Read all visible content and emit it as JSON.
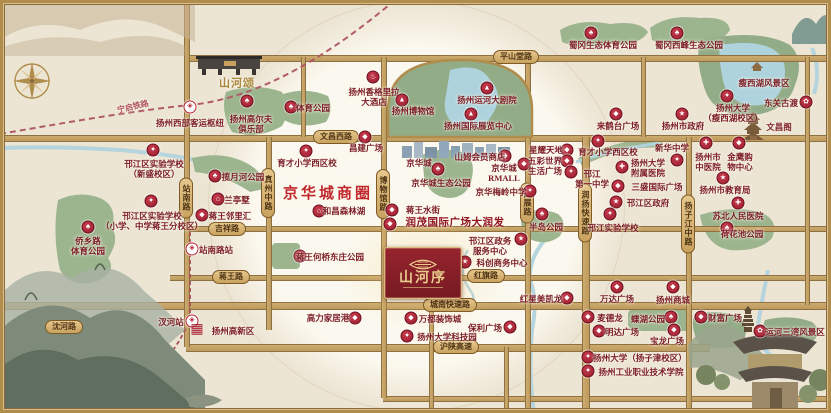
{
  "map": {
    "business_circle": "京华城商圈",
    "project": {
      "name": "山河序",
      "sister": "山河颂"
    },
    "colors": {
      "accent_red": "#a81f30",
      "road_gold": "#c3a267",
      "park_green": "#9db58f",
      "water_blue": "#aed3dd",
      "label_maroon": "#7b1c26"
    },
    "icon_glyphs": {
      "park": "♣",
      "school": "✦",
      "hospital": "✚",
      "gov": "★",
      "mall": "◆",
      "culture": "▲",
      "hotel": "♨",
      "scenic": "✿",
      "residence": "⌂",
      "metro": "◈",
      "hq": "▦"
    },
    "rail_labels": [
      {
        "label": "宁启铁路"
      },
      {
        "label": "宁扬城际（规划中）"
      }
    ],
    "roads": {
      "h": [
        {
          "y": 57,
          "x1": 186,
          "x2": 831,
          "w": 5
        },
        {
          "y": 137,
          "x1": 0,
          "x2": 831,
          "w": 5
        },
        {
          "y": 228,
          "x1": 186,
          "x2": 831,
          "w": 4
        },
        {
          "y": 277,
          "x1": 170,
          "x2": 831,
          "w": 4
        },
        {
          "y": 305,
          "x1": 0,
          "x2": 831,
          "w": 6
        },
        {
          "y": 347,
          "x1": 186,
          "x2": 710,
          "w": 6
        },
        {
          "y": 398,
          "x1": 383,
          "x2": 831,
          "w": 4
        }
      ],
      "v": [
        {
          "x": 186,
          "y1": 0,
          "y2": 347,
          "w": 4
        },
        {
          "x": 268,
          "y1": 137,
          "y2": 330,
          "w": 4
        },
        {
          "x": 302,
          "y1": 57,
          "y2": 137,
          "w": 3
        },
        {
          "x": 383,
          "y1": 57,
          "y2": 398,
          "w": 4
        },
        {
          "x": 527,
          "y1": 57,
          "y2": 413,
          "w": 4
        },
        {
          "x": 585,
          "y1": 137,
          "y2": 413,
          "w": 6
        },
        {
          "x": 642,
          "y1": 57,
          "y2": 137,
          "w": 3
        },
        {
          "x": 688,
          "y1": 137,
          "y2": 413,
          "w": 4
        },
        {
          "x": 806,
          "y1": 57,
          "y2": 305,
          "w": 3
        },
        {
          "x": 430,
          "y1": 277,
          "y2": 413,
          "w": 3
        },
        {
          "x": 505,
          "y1": 347,
          "y2": 413,
          "w": 3
        }
      ]
    },
    "road_labels": [
      {
        "label": "平山堂路",
        "x": 516,
        "y": 57
      },
      {
        "label": "文昌西路",
        "x": 336,
        "y": 137
      },
      {
        "label": "吉祥路",
        "x": 227,
        "y": 229
      },
      {
        "label": "蒋王路",
        "x": 231,
        "y": 277
      },
      {
        "label": "红旗路",
        "x": 486,
        "y": 276
      },
      {
        "label": "城南快速路",
        "x": 450,
        "y": 305
      },
      {
        "label": "沪陕高速",
        "x": 456,
        "y": 347
      },
      {
        "label": "沈河路",
        "x": 64,
        "y": 327
      },
      {
        "label": "站南路",
        "x": 186,
        "y": 198,
        "v": true
      },
      {
        "label": "真州中路",
        "x": 268,
        "y": 193,
        "v": true
      },
      {
        "label": "博物馆路",
        "x": 383,
        "y": 194,
        "v": true
      },
      {
        "label": "国展路",
        "x": 527,
        "y": 203,
        "v": true
      },
      {
        "label": "润扬快速路",
        "x": 585,
        "y": 213,
        "v": true
      },
      {
        "label": "扬子江中路",
        "x": 688,
        "y": 224,
        "v": true
      }
    ],
    "landmarks": [
      {
        "label": "扬州西部客运枢纽",
        "t": [
          190,
          123
        ],
        "i": [
          190,
          107
        ],
        "g": "metro"
      },
      {
        "label": "扬州高尔夫\n俱乐部",
        "t": [
          251,
          124
        ],
        "i": [
          247,
          101
        ],
        "g": "park"
      },
      {
        "label": "体育公园",
        "t": [
          313,
          108
        ],
        "i": [
          291,
          107
        ],
        "g": "park"
      },
      {
        "label": "扬州香格里拉\n大酒店",
        "t": [
          374,
          97
        ],
        "i": [
          373,
          77
        ],
        "g": "hotel"
      },
      {
        "label": "扬州博物馆",
        "t": [
          413,
          111
        ],
        "i": [
          402,
          100
        ],
        "g": "culture"
      },
      {
        "label": "扬州运河大剧院",
        "t": [
          487,
          100
        ],
        "i": [
          487,
          88
        ],
        "g": "culture"
      },
      {
        "label": "扬州国际展览中心",
        "t": [
          478,
          126
        ],
        "i": [
          471,
          114
        ],
        "g": "culture"
      },
      {
        "label": "蜀冈生态体育公园",
        "t": [
          603,
          45
        ],
        "i": [
          591,
          33
        ],
        "g": "park"
      },
      {
        "label": "蜀冈西峰生态公园",
        "t": [
          689,
          45
        ],
        "i": [
          677,
          33
        ],
        "g": "park"
      },
      {
        "label": "瘦西湖风景区",
        "t": [
          764,
          83
        ]
      },
      {
        "label": "扬州大学\n（瘦西湖校区）",
        "t": [
          733,
          113
        ],
        "i": [
          727,
          96
        ],
        "g": "school"
      },
      {
        "label": "东关古渡",
        "t": [
          781,
          103
        ],
        "i": [
          806,
          102
        ],
        "g": "scenic"
      },
      {
        "label": "文昌阁",
        "t": [
          779,
          127
        ]
      },
      {
        "label": "来鹤台广场",
        "t": [
          618,
          126
        ],
        "i": [
          616,
          114
        ],
        "g": "mall"
      },
      {
        "label": "扬州市政府",
        "t": [
          683,
          126
        ],
        "i": [
          682,
          114
        ],
        "g": "gov"
      },
      {
        "label": "邗江区实验学校\n（新盛校区）",
        "t": [
          154,
          169
        ],
        "i": [
          153,
          150
        ],
        "g": "school"
      },
      {
        "label": "揽月河公园",
        "t": [
          243,
          177
        ],
        "i": [
          215,
          176
        ],
        "g": "park"
      },
      {
        "label": "兰亭墅",
        "t": [
          237,
          200
        ],
        "i": [
          218,
          199
        ],
        "g": "residence"
      },
      {
        "label": "蒋王邻里汇",
        "t": [
          230,
          216
        ],
        "i": [
          202,
          215
        ],
        "g": "mall"
      },
      {
        "label": "邗江区实验学校\n（小学、中学蒋王分校区）",
        "t": [
          152,
          221
        ],
        "i": [
          151,
          201
        ],
        "g": "school"
      },
      {
        "label": "侨乡路\n体育公园",
        "t": [
          88,
          246
        ],
        "i": [
          88,
          227
        ],
        "g": "park"
      },
      {
        "label": "站南路站",
        "t": [
          216,
          250
        ],
        "i": [
          192,
          249
        ],
        "g": "metro"
      },
      {
        "label": "育才小学西区校",
        "t": [
          307,
          163
        ],
        "i": [
          306,
          151
        ],
        "g": "school"
      },
      {
        "label": "昌建广场",
        "t": [
          366,
          148
        ],
        "i": [
          365,
          137
        ],
        "g": "mall"
      },
      {
        "label": "和昌森林湖",
        "t": [
          344,
          211
        ],
        "i": [
          319,
          211
        ],
        "g": "residence"
      },
      {
        "label": "京华城",
        "t": [
          419,
          163
        ]
      },
      {
        "label": "山姆会员商店",
        "t": [
          480,
          157
        ],
        "i": [
          505,
          156
        ],
        "g": "mall"
      },
      {
        "label": "京华城\nRMALL",
        "t": [
          504,
          173
        ],
        "i": [
          524,
          164
        ],
        "g": "mall"
      },
      {
        "label": "京华城生态公园",
        "t": [
          441,
          183
        ],
        "i": [
          438,
          169
        ],
        "g": "park"
      },
      {
        "label": "京华梅岭中学",
        "t": [
          501,
          192
        ],
        "i": [
          530,
          191
        ],
        "g": "school"
      },
      {
        "label": "星耀天地",
        "t": [
          546,
          150
        ],
        "i": [
          567,
          150
        ],
        "g": "mall"
      },
      {
        "label": "五彩世界\n生活广场",
        "t": [
          545,
          166
        ],
        "i": [
          567,
          161
        ],
        "g": "mall"
      },
      {
        "label": "蒋王水街",
        "t": [
          423,
          210
        ],
        "i": [
          392,
          210
        ],
        "g": "mall"
      },
      {
        "label": "润茂国际广场大润发",
        "t": [
          455,
          224
        ],
        "i": [
          390,
          224
        ],
        "g": "mall",
        "cls": "big"
      },
      {
        "label": "蒋王何桥东庄公园",
        "t": [
          330,
          257
        ],
        "i": [
          300,
          256
        ],
        "g": "park"
      },
      {
        "label": "邗江区政务\n服务中心",
        "t": [
          490,
          246
        ],
        "i": [
          521,
          239
        ],
        "g": "gov"
      },
      {
        "label": "科创商务中心",
        "t": [
          502,
          263
        ],
        "i": [
          465,
          262
        ],
        "g": "gov"
      },
      {
        "label": "半岛公园",
        "t": [
          546,
          227
        ],
        "i": [
          542,
          214
        ],
        "g": "park"
      },
      {
        "label": "邗江\n第一中学",
        "t": [
          592,
          179
        ],
        "i": [
          571,
          172
        ],
        "g": "school"
      },
      {
        "label": "育才小学西区校",
        "t": [
          608,
          152
        ],
        "i": [
          598,
          141
        ],
        "g": "school"
      },
      {
        "label": "新华中学",
        "t": [
          672,
          148
        ],
        "i": [
          677,
          160
        ],
        "g": "school"
      },
      {
        "label": "扬州大学\n附属医院",
        "t": [
          648,
          168
        ],
        "i": [
          622,
          167
        ],
        "g": "hospital"
      },
      {
        "label": "三盛国际广场",
        "t": [
          657,
          187
        ],
        "i": [
          618,
          186
        ],
        "g": "mall"
      },
      {
        "label": "邗江区政府",
        "t": [
          648,
          203
        ],
        "i": [
          616,
          202
        ],
        "g": "gov"
      },
      {
        "label": "邗江实验学校",
        "t": [
          613,
          228
        ],
        "i": [
          610,
          214
        ],
        "g": "school"
      },
      {
        "label": "扬州市\n中医院",
        "t": [
          708,
          162
        ],
        "i": [
          706,
          143
        ],
        "g": "hospital"
      },
      {
        "label": "金鹰购\n物中心",
        "t": [
          740,
          162
        ],
        "i": [
          739,
          143
        ],
        "g": "mall"
      },
      {
        "label": "扬州市教育局",
        "t": [
          725,
          190
        ],
        "i": [
          723,
          178
        ],
        "g": "gov"
      },
      {
        "label": "苏北人民医院",
        "t": [
          738,
          216
        ],
        "i": [
          738,
          203
        ],
        "g": "hospital"
      },
      {
        "label": "荷花池公园",
        "t": [
          742,
          234
        ],
        "i": [
          727,
          228
        ],
        "g": "park"
      },
      {
        "label": "汊河站",
        "t": [
          171,
          322
        ],
        "i": [
          192,
          321
        ],
        "g": "metro"
      },
      {
        "label": "扬州高新区",
        "t": [
          233,
          331
        ],
        "i": [
          197,
          330
        ],
        "g": "hq"
      },
      {
        "label": "高力家居港",
        "t": [
          328,
          318
        ],
        "i": [
          355,
          318
        ],
        "g": "mall"
      },
      {
        "label": "万都装饰城",
        "t": [
          440,
          319
        ],
        "i": [
          411,
          318
        ],
        "g": "mall"
      },
      {
        "label": "扬州大学科技园",
        "t": [
          447,
          337
        ],
        "i": [
          407,
          336
        ],
        "g": "school"
      },
      {
        "label": "保利广场",
        "t": [
          485,
          328
        ],
        "i": [
          510,
          327
        ],
        "g": "mall"
      },
      {
        "label": "红星美凯龙",
        "t": [
          541,
          299
        ],
        "i": [
          567,
          298
        ],
        "g": "mall"
      },
      {
        "label": "万达广场",
        "t": [
          617,
          299
        ],
        "i": [
          617,
          287
        ],
        "g": "mall"
      },
      {
        "label": "扬州商城",
        "t": [
          673,
          300
        ],
        "i": [
          673,
          287
        ],
        "g": "mall"
      },
      {
        "label": "麦德龙",
        "t": [
          610,
          318
        ],
        "i": [
          588,
          317
        ],
        "g": "mall"
      },
      {
        "label": "蝶湖公园",
        "t": [
          648,
          319
        ],
        "i": [
          671,
          317
        ],
        "g": "park"
      },
      {
        "label": "明达广场",
        "t": [
          622,
          332
        ],
        "i": [
          599,
          331
        ],
        "g": "mall"
      },
      {
        "label": "宝龙广场",
        "t": [
          667,
          341
        ],
        "i": [
          674,
          330
        ],
        "g": "mall"
      },
      {
        "label": "扬州大学（扬子津校区）",
        "t": [
          640,
          358
        ],
        "i": [
          588,
          357
        ],
        "g": "school"
      },
      {
        "label": "扬州工业职业技术学院",
        "t": [
          641,
          372
        ],
        "i": [
          588,
          371
        ],
        "g": "school"
      },
      {
        "label": "财富广场",
        "t": [
          725,
          318
        ],
        "i": [
          701,
          317
        ],
        "g": "mall"
      },
      {
        "label": "运河三湾风景区",
        "t": [
          795,
          332
        ],
        "i": [
          760,
          331
        ],
        "g": "scenic"
      }
    ]
  }
}
